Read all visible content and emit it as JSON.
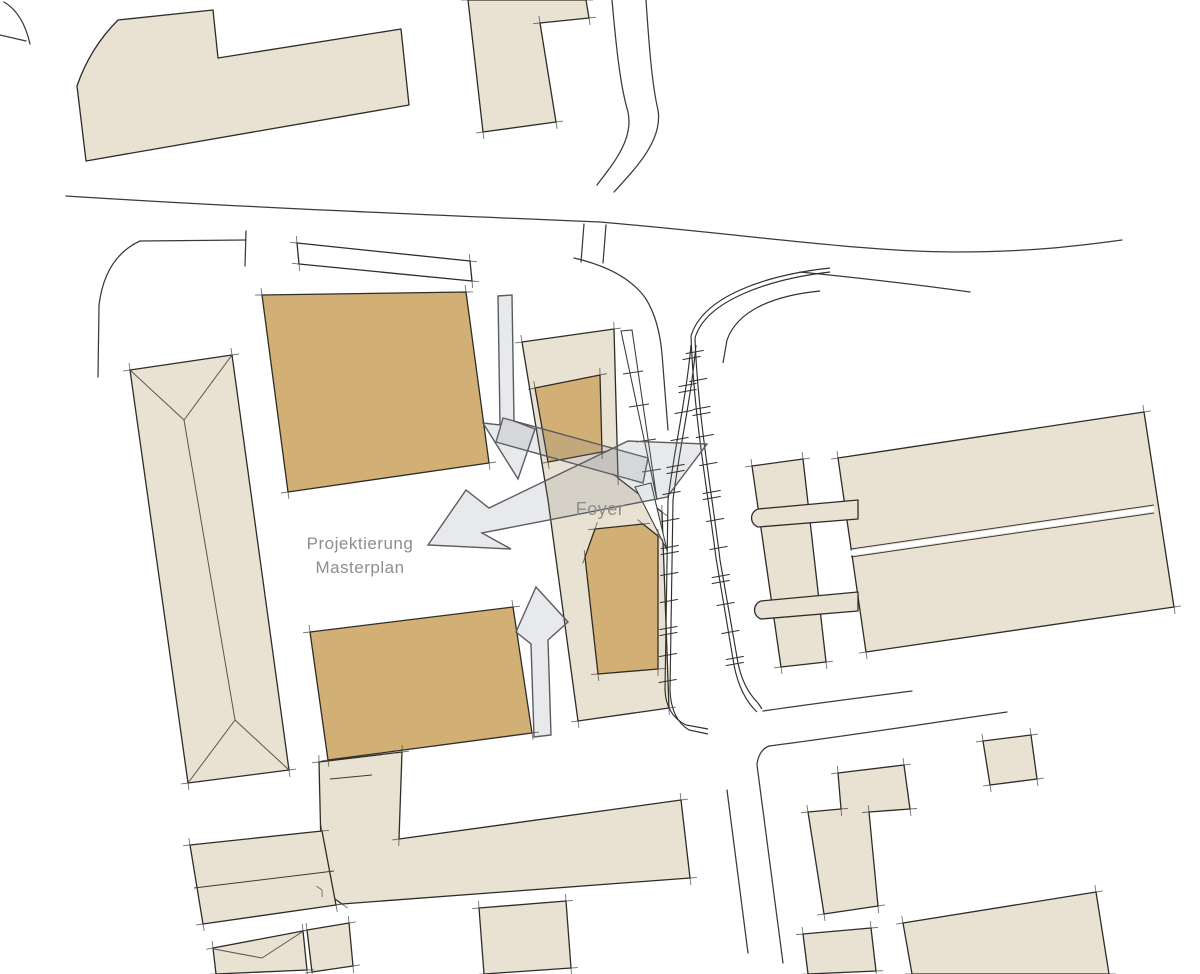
{
  "labels": {
    "projektierung_line1": "Projektierung",
    "projektierung_line2": "Masterplan",
    "foyer": "Foyer"
  },
  "palette": {
    "background": "#ffffff",
    "building_fill": "#e9e2d2",
    "highlight_fill": "#d2b075",
    "outline": "#2e2c28",
    "road": "#3b3a37",
    "arrow_fill": "rgba(130,132,145,0.18)",
    "arrow_outline": "#5b5b63",
    "label_color": "#8e8e90"
  }
}
